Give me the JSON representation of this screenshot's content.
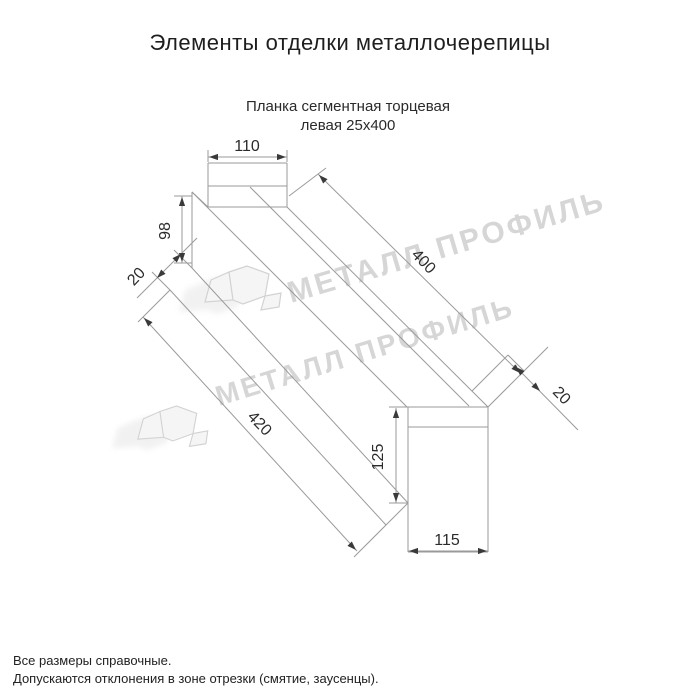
{
  "title": "Элементы отделки металлочерепицы",
  "drawing": {
    "subtitle_line1": "Планка сегментная торцевая",
    "subtitle_line2": "левая 25х400",
    "dimensions": {
      "top_width": "110",
      "left_height": "98",
      "left_hem": "20",
      "length_top": "400",
      "length_bottom": "420",
      "right_hem": "20",
      "end_height": "125",
      "end_width": "115"
    }
  },
  "watermark": {
    "text": "МЕТАЛЛ ПРОФИЛЬ",
    "color": "#d6d6d6"
  },
  "footer": {
    "note1": "Все размеры справочные.",
    "note2": "Допускаются отклонения в зоне отрезки (смятие, заусенцы)."
  },
  "colors": {
    "background": "#ffffff",
    "drawing_line": "#9a9a9a",
    "dimension_text": "#2b2b2b",
    "arrowhead": "#3a3a3a"
  }
}
